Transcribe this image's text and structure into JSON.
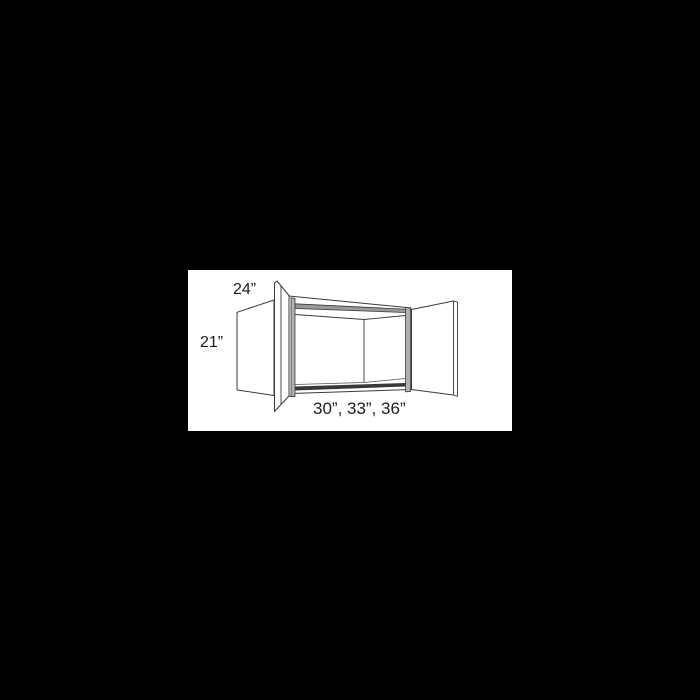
{
  "page": {
    "background_color": "#000000",
    "canvas_color": "#ffffff"
  },
  "diagram": {
    "kind": "wall-cabinet-dimension-drawing",
    "description": "Open two-door wall cabinet shown in perspective with dimension labels",
    "labels": {
      "depth": "24”",
      "height": "21”",
      "widths": "30”, 33”, 36”"
    },
    "colors": {
      "line": "#3b3b3b",
      "stile_fill": "#b0b0b0",
      "top_shade_fill": "#999999",
      "shelf_edge_fill": "#383838",
      "label_text": "#1c1c1c"
    }
  }
}
